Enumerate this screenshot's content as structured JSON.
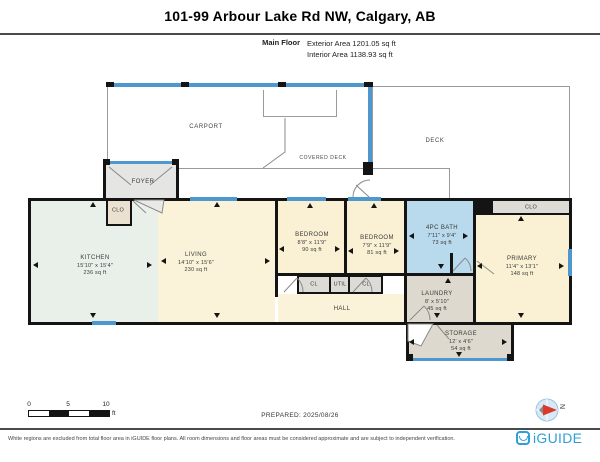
{
  "header": {
    "title": "101-99 Arbour Lake Rd NW, Calgary, AB",
    "floor_label": "Main Floor",
    "exterior_area": "Exterior Area 1201.05 sq ft",
    "interior_area": "Interior Area 1138.93 sq ft"
  },
  "rooms": {
    "kitchen": {
      "name": "KITCHEN",
      "dims": "15'10\" x 15'4\"",
      "area": "236 sq ft"
    },
    "living": {
      "name": "LIVING",
      "dims": "14'10\" x 15'6\"",
      "area": "230 sq ft"
    },
    "bedroom1": {
      "name": "BEDROOM",
      "dims": "8'8\" x 11'9\"",
      "area": "90 sq ft"
    },
    "bedroom2": {
      "name": "BEDROOM",
      "dims": "7'9\" x 11'9\"",
      "area": "81 sq ft"
    },
    "bath": {
      "name": "4PC BATH",
      "dims": "7'11\" x 9'4\"",
      "area": "73 sq ft"
    },
    "primary": {
      "name": "PRIMARY",
      "dims": "11'4\" x 13'1\"",
      "area": "148 sq ft"
    },
    "laundry": {
      "name": "LAUNDRY",
      "dims": "8' x 5'10\"",
      "area": "45 sq ft"
    },
    "storage": {
      "name": "STORAGE",
      "dims": "12' x 4'6\"",
      "area": "54 sq ft"
    },
    "hall": {
      "name": "HALL"
    },
    "foyer": {
      "name": "FOYER"
    },
    "clo_foyer": {
      "name": "CLO"
    },
    "clo_primary": {
      "name": "CLO"
    },
    "cl_left": {
      "name": "CL"
    },
    "util": {
      "name": "UTIL"
    },
    "cl_right": {
      "name": "CL"
    },
    "carport": {
      "name": "CARPORT"
    },
    "covered_deck": {
      "name": "COVERED DECK"
    },
    "deck": {
      "name": "DECK"
    }
  },
  "scale_bar": {
    "tick0": "0",
    "tick5": "5",
    "tick10": "10",
    "unit": "ft"
  },
  "prepared": "PREPARED: 2025/08/26",
  "compass": {
    "north_label": "N"
  },
  "footer": {
    "disclaimer": "White regions are excluded from total floor area in iGUIDE floor plans. All room dimensions and floor areas must be considered approximate and are subject to independent verification.",
    "brand": "iGUIDE"
  },
  "colors": {
    "wall": "#141414",
    "window": "#4f97cf",
    "bath_fill": "#b9d9ec",
    "room_cream": "#faf0d4",
    "kitchen_fill": "#e9f0e9",
    "closet_fill": "#dcdbd6",
    "laundry_fill": "#ded9ce",
    "foyer_fill": "#e5e5e3",
    "brand_blue": "#2fa0d6",
    "compass_red": "#d93a2b"
  }
}
